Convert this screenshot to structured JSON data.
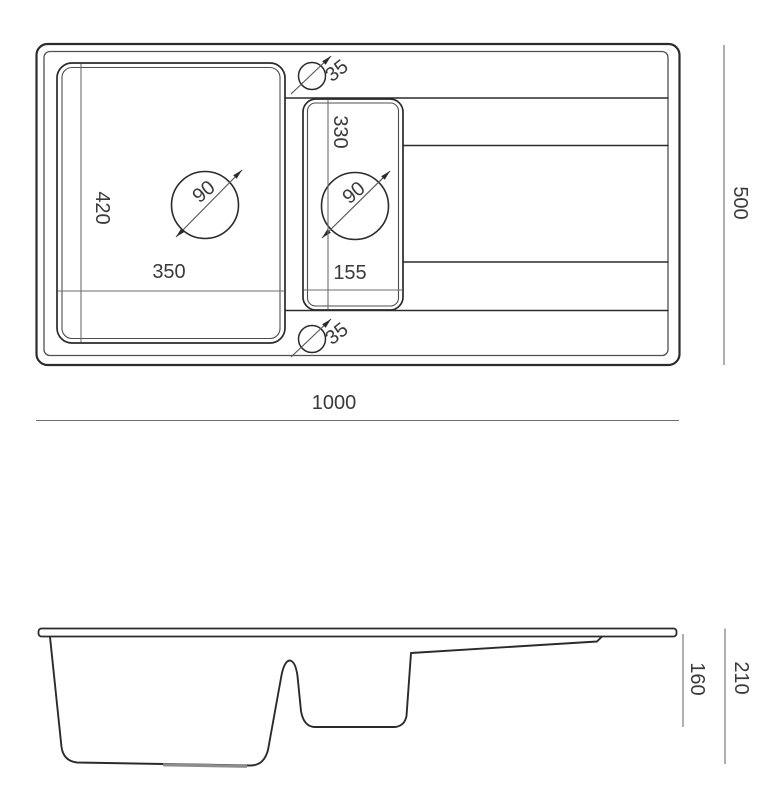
{
  "drawing": {
    "subject": "kitchen sink with drainboard - dimensioned top view and profile view",
    "colors": {
      "background": "#ffffff",
      "outline": "#2b2b2b",
      "secondary_line": "#4f4f4f",
      "dimension_line": "#6e6e6e",
      "label_text": "#3a3a3a",
      "recess_gray": "#8d8d8d"
    }
  },
  "top_view": {
    "overall": {
      "width": "1000",
      "depth": "500"
    },
    "main_bowl": {
      "width": "350",
      "depth": "420",
      "drain": "90"
    },
    "half_bowl": {
      "width": "155",
      "depth": "330",
      "drain": "90"
    },
    "tap_holes": {
      "top": "35",
      "bottom": "35"
    }
  },
  "side_view": {
    "half_bowl_depth": "160",
    "total_depth": "210"
  }
}
